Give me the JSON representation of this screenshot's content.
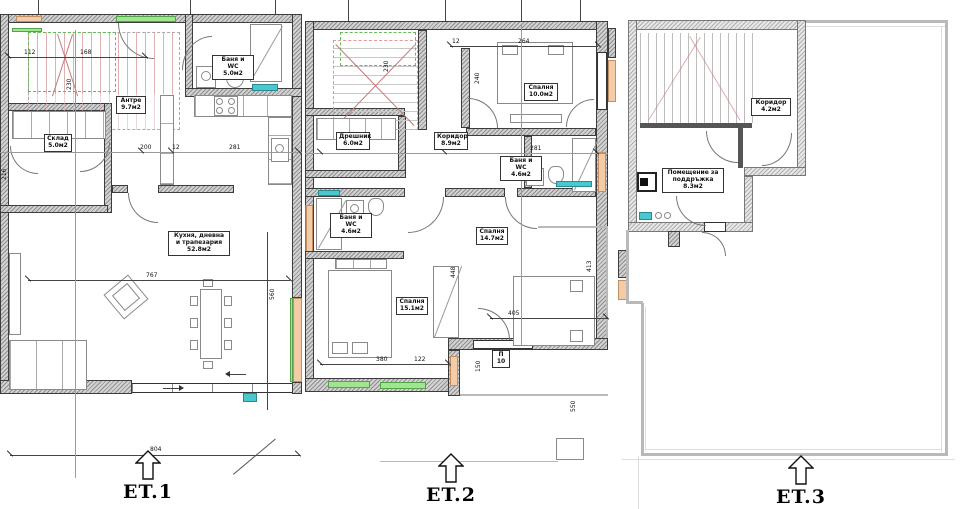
{
  "floors": {
    "et1": {
      "label": "ET.1",
      "rooms": {
        "bath": {
          "name": "Баня и WC",
          "area": "5.0м2"
        },
        "entry": {
          "name": "Антре",
          "area": "9.7м2"
        },
        "storage": {
          "name": "Склад",
          "area": "5.0м2"
        },
        "living": {
          "name": "Кухня, дневна и трапезария",
          "area": "52.8м2"
        }
      },
      "dims": {
        "d112": "112",
        "d168": "168",
        "d230": "230",
        "d200": "200",
        "d12": "12",
        "d281": "281",
        "d216": "216",
        "d767": "767",
        "d560": "560",
        "d804": "804"
      }
    },
    "et2": {
      "label": "ET.2",
      "rooms": {
        "bedroom1": {
          "name": "Спалня",
          "area": "10.0м2"
        },
        "closet": {
          "name": "Дрешник",
          "area": "6.0м2"
        },
        "corridor": {
          "name": "Коридор",
          "area": "8.9м2"
        },
        "bath1": {
          "name": "Баня и WC",
          "area": "4.6м2"
        },
        "bath2": {
          "name": "Баня и WC",
          "area": "4.6м2"
        },
        "bedroom2": {
          "name": "Спалня",
          "area": "15.1м2"
        },
        "bedroom3": {
          "name": "Спалня",
          "area": "14.7м2"
        }
      },
      "dims": {
        "d12": "12",
        "d264": "264",
        "d230": "230",
        "d240": "240",
        "d244": "244",
        "d236": "236",
        "d281": "281",
        "d448": "448",
        "d380": "380",
        "d122": "122",
        "d405": "405",
        "d150": "150",
        "d413": "413",
        "d550": "550",
        "p10": "П 10"
      }
    },
    "et3": {
      "label": "ET.3",
      "rooms": {
        "corridor": {
          "name": "Коридор",
          "area": "4.2м2"
        },
        "maintenance": {
          "name": "Помещение за поддръжка",
          "area": "8.3м2"
        }
      }
    }
  }
}
